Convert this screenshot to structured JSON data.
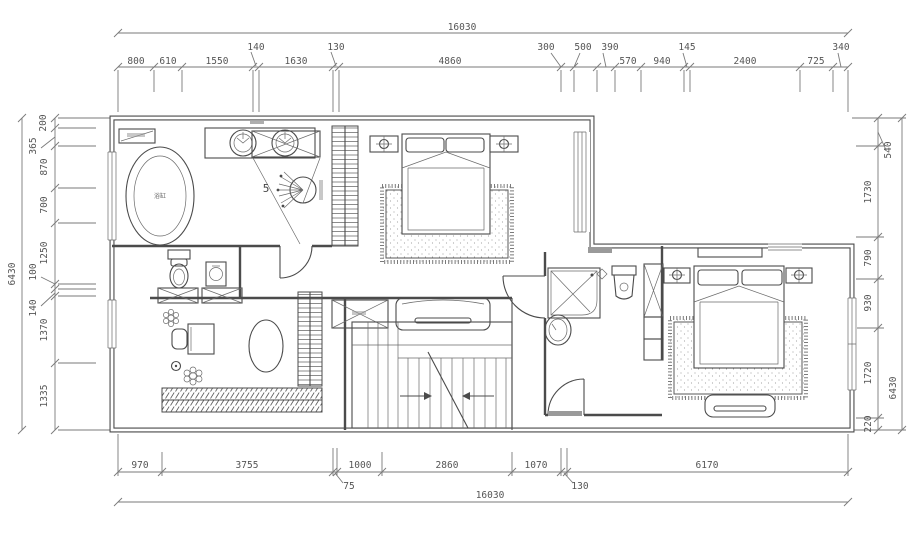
{
  "drawing": {
    "type": "architectural floor plan",
    "background": "#ffffff",
    "line_color": "#4b4b4b",
    "dim_text_color": "#555555"
  },
  "dimensions": {
    "top": {
      "total": "16030",
      "segments": [
        "800",
        "610",
        "1550",
        "140",
        "1630",
        "130",
        "4860",
        "300",
        "500",
        "390",
        "570",
        "940",
        "145",
        "2400",
        "725",
        "340"
      ]
    },
    "bottom": {
      "total": "16030",
      "segments": [
        "970",
        "3755",
        "75",
        "1000",
        "2860",
        "1070",
        "130",
        "6170"
      ]
    },
    "left": {
      "total": "6430",
      "segments": [
        "200",
        "365",
        "870",
        "700",
        "1250",
        "100",
        "140",
        "1370",
        "1335"
      ]
    },
    "right": {
      "total": "6430",
      "segments": [
        "540",
        "1730",
        "790",
        "930",
        "1720",
        "220"
      ]
    }
  },
  "labels": {
    "shower_number": "5",
    "bathtub": "浴缸"
  }
}
